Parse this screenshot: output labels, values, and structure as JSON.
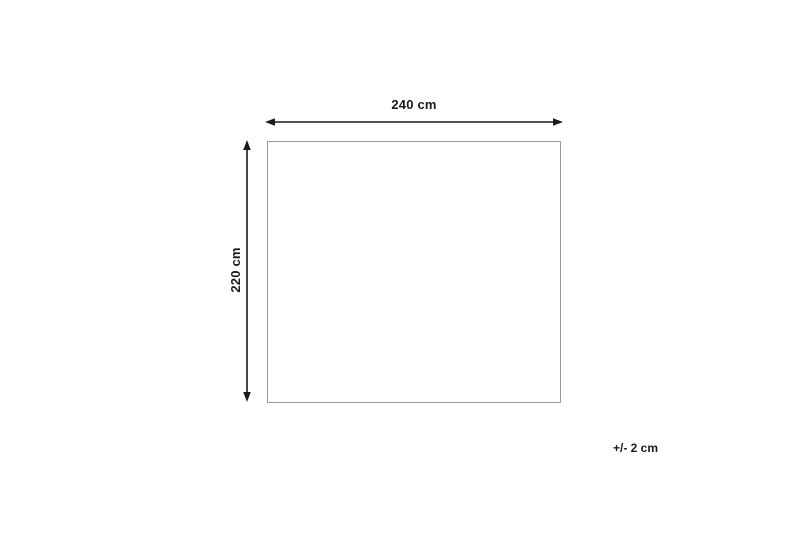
{
  "diagram": {
    "width_label": "240 cm",
    "height_label": "220 cm",
    "tolerance_label": "+/- 2 cm",
    "colors": {
      "arrow": "#1a1a1a",
      "rect_border": "#999999",
      "text": "#1a1a1a",
      "background": "#ffffff"
    }
  }
}
